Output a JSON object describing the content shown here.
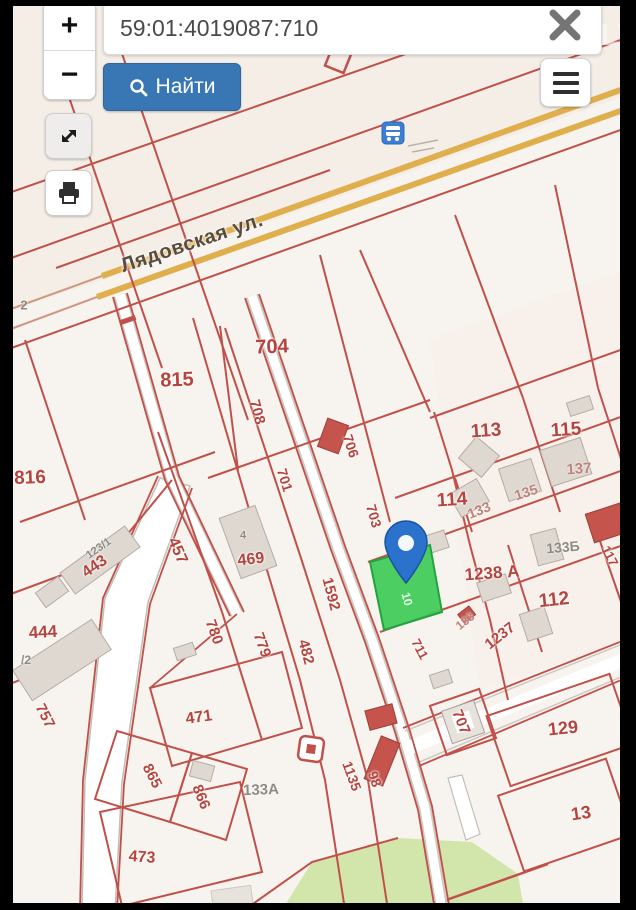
{
  "toolbar": {
    "zoom_in_label": "+",
    "zoom_out_label": "−",
    "search_value": "59:01:4019087:710",
    "find_label": "Найти"
  },
  "watermark": {
    "text": "ONREALT"
  },
  "icons": {
    "search": "magnifier",
    "close": "x-cross",
    "menu": "hamburger",
    "expand": "diagonal-arrows",
    "print": "printer",
    "bus_stop": "bus",
    "pin": "map-pin"
  },
  "map": {
    "selected_parcel_color": "#3ecb57",
    "boundary_color": "#c0504a",
    "road_color": "#dfae4d",
    "labels": [
      {
        "text": "Лядовская ул.",
        "x": 192,
        "y": 243,
        "rot": -18.5,
        "kind": "street",
        "size": 20
      },
      {
        "text": "704",
        "x": 272,
        "y": 347,
        "rot": -2,
        "kind": "red",
        "size": 20
      },
      {
        "text": "815",
        "x": 177,
        "y": 380,
        "rot": -2,
        "kind": "red",
        "size": 20
      },
      {
        "text": "816",
        "x": 30,
        "y": 478,
        "rot": -2,
        "kind": "red",
        "size": 19
      },
      {
        "text": "708",
        "x": 257,
        "y": 412,
        "rot": 75,
        "kind": "red",
        "size": 15
      },
      {
        "text": "706",
        "x": 351,
        "y": 446,
        "rot": 72,
        "kind": "red",
        "size": 14
      },
      {
        "text": "701",
        "x": 285,
        "y": 480,
        "rot": 73,
        "kind": "red",
        "size": 14
      },
      {
        "text": "703",
        "x": 374,
        "y": 516,
        "rot": 74,
        "kind": "red",
        "size": 14
      },
      {
        "text": "113",
        "x": 486,
        "y": 431,
        "rot": -4,
        "kind": "red",
        "size": 19
      },
      {
        "text": "115",
        "x": 566,
        "y": 430,
        "rot": -4,
        "kind": "red",
        "size": 19
      },
      {
        "text": "137",
        "x": 579,
        "y": 469,
        "rot": -4,
        "kind": "faded",
        "size": 15
      },
      {
        "text": "114",
        "x": 452,
        "y": 500,
        "rot": -4,
        "kind": "red",
        "size": 19
      },
      {
        "text": "133",
        "x": 479,
        "y": 510,
        "rot": -22,
        "kind": "faded",
        "size": 14
      },
      {
        "text": "135",
        "x": 526,
        "y": 492,
        "rot": -18,
        "kind": "faded",
        "size": 14
      },
      {
        "text": "1238 А",
        "x": 492,
        "y": 573,
        "rot": -4,
        "kind": "red",
        "size": 17
      },
      {
        "text": "133Б",
        "x": 563,
        "y": 547,
        "rot": -5,
        "kind": "gray",
        "size": 14
      },
      {
        "text": "112",
        "x": 554,
        "y": 600,
        "rot": -6,
        "kind": "red",
        "size": 19
      },
      {
        "text": "1237",
        "x": 500,
        "y": 636,
        "rot": -38,
        "kind": "red",
        "size": 15
      },
      {
        "text": "133",
        "x": 465,
        "y": 621,
        "rot": -38,
        "kind": "faded",
        "size": 12
      },
      {
        "text": "117",
        "x": 610,
        "y": 556,
        "rot": 62,
        "kind": "red",
        "size": 13
      },
      {
        "text": "457",
        "x": 177,
        "y": 551,
        "rot": 66,
        "kind": "red",
        "size": 16
      },
      {
        "text": "443",
        "x": 95,
        "y": 567,
        "rot": -35,
        "kind": "red",
        "size": 16
      },
      {
        "text": "123/1",
        "x": 99,
        "y": 549,
        "rot": -35,
        "kind": "gray",
        "size": 11
      },
      {
        "text": "4",
        "x": 243,
        "y": 536,
        "rot": 0,
        "kind": "gray",
        "size": 11
      },
      {
        "text": "469",
        "x": 251,
        "y": 560,
        "rot": -6,
        "kind": "red",
        "size": 16
      },
      {
        "text": "444",
        "x": 43,
        "y": 632,
        "rot": -3,
        "kind": "red",
        "size": 17
      },
      {
        "text": "/2",
        "x": 26,
        "y": 660,
        "rot": 0,
        "kind": "gray",
        "size": 12
      },
      {
        "text": "757",
        "x": 45,
        "y": 716,
        "rot": 63,
        "kind": "red",
        "size": 15
      },
      {
        "text": "780",
        "x": 214,
        "y": 632,
        "rot": 70,
        "kind": "red",
        "size": 15
      },
      {
        "text": "779",
        "x": 262,
        "y": 645,
        "rot": 70,
        "kind": "red",
        "size": 15
      },
      {
        "text": "482",
        "x": 306,
        "y": 652,
        "rot": 75,
        "kind": "red",
        "size": 15
      },
      {
        "text": "1592",
        "x": 331,
        "y": 594,
        "rot": 75,
        "kind": "red",
        "size": 15
      },
      {
        "text": "471",
        "x": 199,
        "y": 718,
        "rot": -8,
        "kind": "red",
        "size": 16
      },
      {
        "text": "865",
        "x": 152,
        "y": 776,
        "rot": 63,
        "kind": "red",
        "size": 15
      },
      {
        "text": "866",
        "x": 201,
        "y": 797,
        "rot": 68,
        "kind": "red",
        "size": 15
      },
      {
        "text": "473",
        "x": 142,
        "y": 858,
        "rot": 4,
        "kind": "red",
        "size": 16
      },
      {
        "text": "133А",
        "x": 261,
        "y": 790,
        "rot": -2,
        "kind": "gray",
        "size": 15
      },
      {
        "text": "1135",
        "x": 352,
        "y": 776,
        "rot": 70,
        "kind": "red",
        "size": 14
      },
      {
        "text": "98",
        "x": 375,
        "y": 779,
        "rot": 70,
        "kind": "red",
        "size": 14
      },
      {
        "text": "707",
        "x": 461,
        "y": 722,
        "rot": 68,
        "kind": "red",
        "size": 15
      },
      {
        "text": "711",
        "x": 420,
        "y": 649,
        "rot": 62,
        "kind": "red",
        "size": 13
      },
      {
        "text": "129",
        "x": 563,
        "y": 728,
        "rot": -6,
        "kind": "red",
        "size": 18
      },
      {
        "text": "13",
        "x": 581,
        "y": 813,
        "rot": -8,
        "kind": "red",
        "size": 18
      },
      {
        "text": "2",
        "x": 24,
        "y": 305,
        "rot": 0,
        "kind": "gray",
        "size": 13
      },
      {
        "text": "10",
        "x": 407,
        "y": 599,
        "rot": 75,
        "kind": "white",
        "size": 12
      }
    ]
  }
}
